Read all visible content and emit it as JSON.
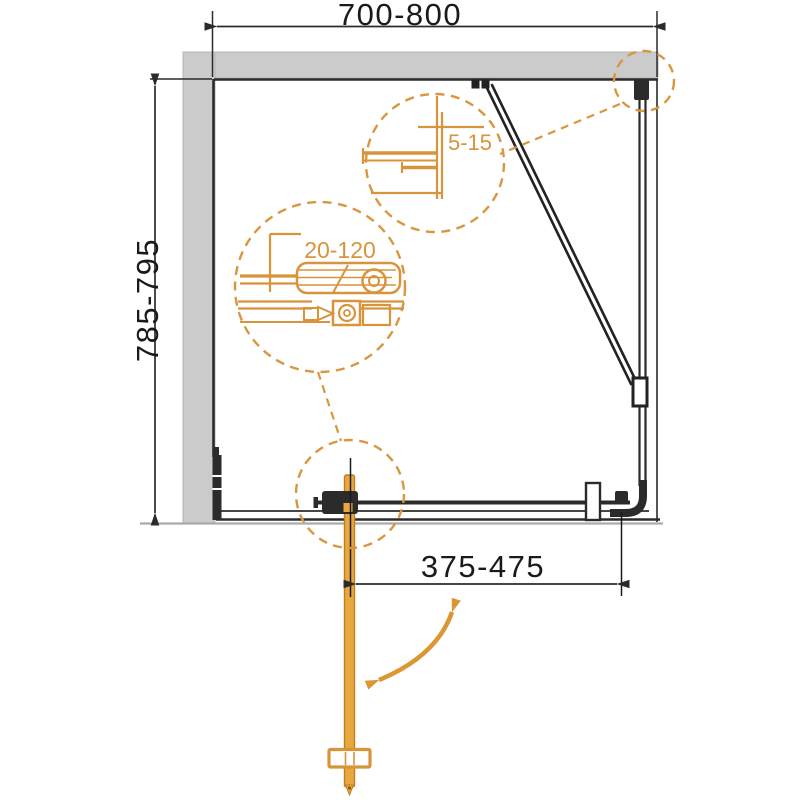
{
  "diagram": {
    "type": "shower-enclosure-installation-plan",
    "labels": {
      "width_range": "700-800",
      "depth_range": "785-795",
      "door_opening_range": "375-475",
      "wall_profile_adjustment": "5-15",
      "hinge_adjustment": "20-120"
    },
    "colors": {
      "accent_orange": "#D8943B",
      "door_orange_fill": "#E9A83F",
      "door_orange_border": "#C07E1F",
      "swing_arrow_orange": "#DD9732",
      "wall_gray": "#CBCBCB",
      "wall_gray_edge": "#B5B5B5",
      "baseline_gray": "#ABABAB",
      "line_dark": "#2B2B2B",
      "dimension_text": "#1A1A1A"
    }
  }
}
